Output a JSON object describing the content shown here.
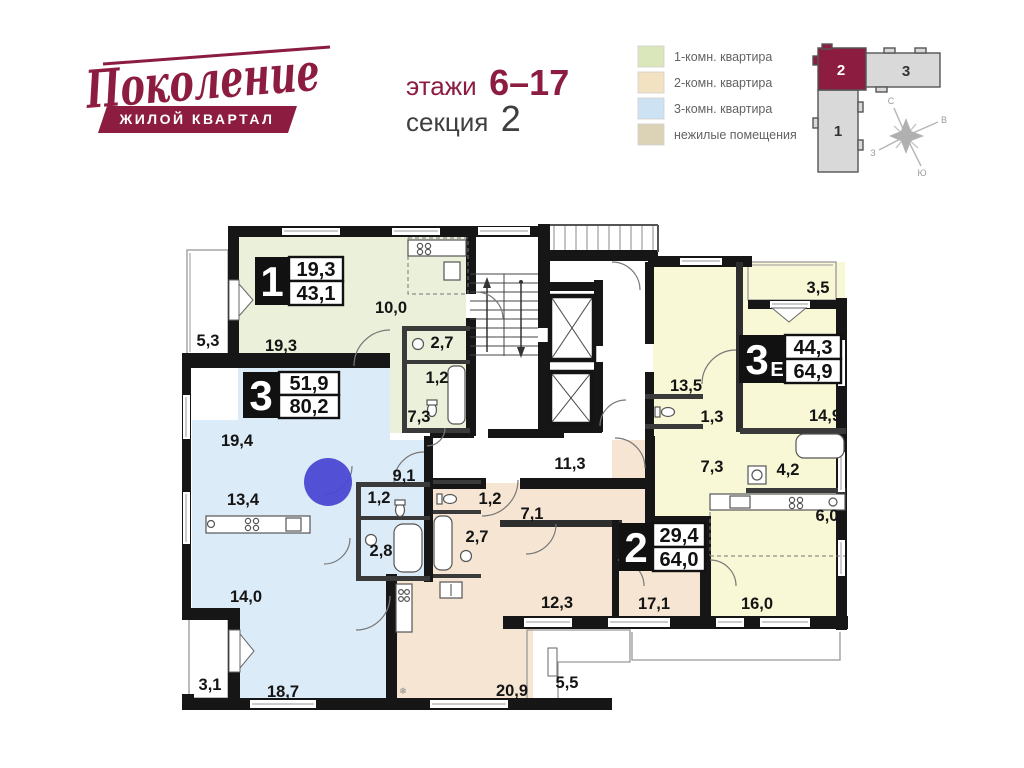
{
  "brand": {
    "logo_text": "Поколение",
    "logo_sub": "ЖИЛОЙ КВАРТАЛ",
    "color": "#8c1d40"
  },
  "title": {
    "floors_label": "этажи",
    "floors_value": "6–17",
    "section_label": "секция",
    "section_value": "2"
  },
  "legend": {
    "items": [
      {
        "label": "1-комн. квартира",
        "color": "#d9e7ba"
      },
      {
        "label": "2-комн. квартира",
        "color": "#f3e2c1"
      },
      {
        "label": "3-комн. квартира",
        "color": "#cde2f3"
      },
      {
        "label": "нежилые помещения",
        "color": "#dcd3b6"
      }
    ]
  },
  "keymap": {
    "active_color": "#8c1d40",
    "inactive_color": "#d9d9d9",
    "blocks": [
      {
        "label": "1"
      },
      {
        "label": "2"
      },
      {
        "label": "3"
      }
    ],
    "compass": {
      "n": "С",
      "e": "В",
      "w": "З",
      "s": "Ю"
    }
  },
  "plan": {
    "colors": {
      "apt1": "#eaf0da",
      "apt2": "#f6e5d2",
      "apt3": "#dcebf8",
      "apt3e": "#f8f7d6",
      "wall": "#161616"
    },
    "apartments": [
      {
        "id": "apt-1",
        "type_label": "1",
        "type_suffix": "",
        "area_living": "19,3",
        "area_total": "43,1"
      },
      {
        "id": "apt-3",
        "type_label": "3",
        "type_suffix": "",
        "area_living": "51,9",
        "area_total": "80,2"
      },
      {
        "id": "apt-3e",
        "type_label": "3",
        "type_suffix": "Е",
        "area_living": "44,3",
        "area_total": "64,9"
      },
      {
        "id": "apt-2",
        "type_label": "2",
        "type_suffix": "",
        "area_living": "29,4",
        "area_total": "64,0"
      }
    ],
    "rooms": [
      {
        "area": "5,3"
      },
      {
        "area": "19,3"
      },
      {
        "area": "10,0"
      },
      {
        "area": "2,7"
      },
      {
        "area": "1,2"
      },
      {
        "area": "7,3"
      },
      {
        "area": "19,4"
      },
      {
        "area": "13,4"
      },
      {
        "area": "9,1"
      },
      {
        "area": "1,2"
      },
      {
        "area": "2,8"
      },
      {
        "area": "14,0"
      },
      {
        "area": "3,1"
      },
      {
        "area": "18,7"
      },
      {
        "area": "11,3"
      },
      {
        "area": "3,5"
      },
      {
        "area": "13,5"
      },
      {
        "area": "1,3"
      },
      {
        "area": "14,9"
      },
      {
        "area": "7,3"
      },
      {
        "area": "4,2"
      },
      {
        "area": "6,0"
      },
      {
        "area": "16,0"
      },
      {
        "area": "1,2"
      },
      {
        "area": "2,7"
      },
      {
        "area": "7,1"
      },
      {
        "area": "12,3"
      },
      {
        "area": "17,1"
      },
      {
        "area": "20,9"
      },
      {
        "area": "5,5"
      }
    ]
  },
  "overlay": {
    "marker_color": "#4a49d4"
  }
}
